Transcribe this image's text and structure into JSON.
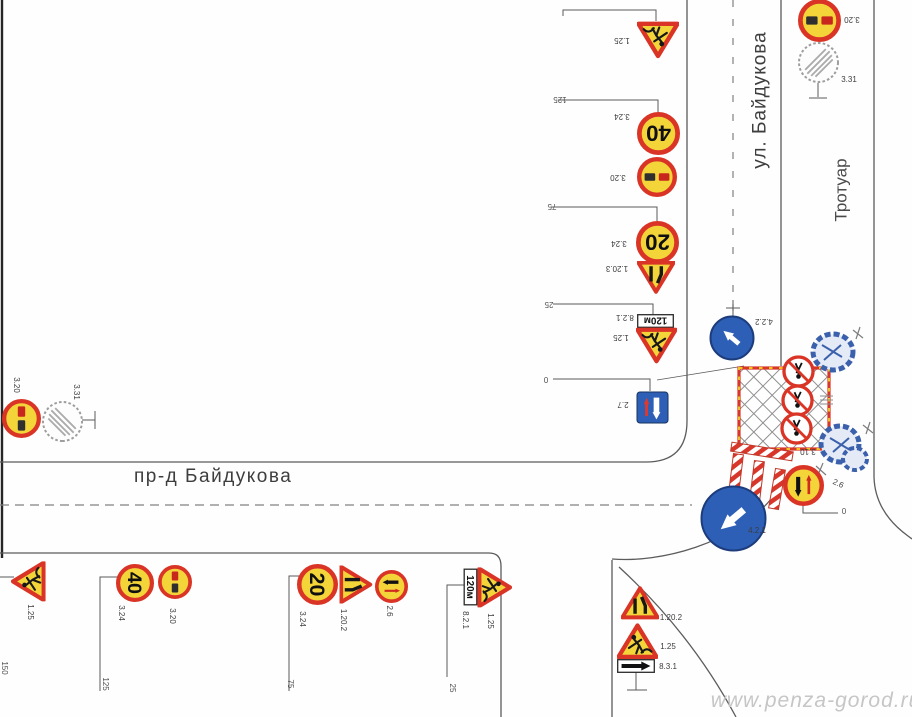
{
  "streets": {
    "vertical": "ул. Байдукова",
    "horizontal": "пр-д Байдукова",
    "sidewalk": "Тротуар"
  },
  "watermark": "www.penza-gorod.ru",
  "colors": {
    "sign_yellow": "#f3d53a",
    "sign_red": "#d93425",
    "sign_blue": "#2e5fb7",
    "zone_red": "#d8362a",
    "lamp_yellow": "#f2c21f",
    "tree_blue": "#3b60ac",
    "line_gray": "#5c5c5c"
  },
  "signs": [
    {
      "name": "sign-1.25-top",
      "t": "works",
      "x": 658,
      "y": 40,
      "s": 42,
      "rot": 180
    },
    {
      "name": "sign-3.24-40-top",
      "t": "speed",
      "tx": "40",
      "x": 658,
      "y": 133,
      "s": 43,
      "rot": 180
    },
    {
      "name": "sign-3.20-top",
      "t": "noov",
      "x": 657,
      "y": 177,
      "s": 40,
      "rot": 180
    },
    {
      "name": "sign-3.24-20-top",
      "t": "speed",
      "tx": "20",
      "x": 657,
      "y": 242,
      "s": 43,
      "rot": 180
    },
    {
      "name": "sign-1.20.3-top",
      "t": "narrowL",
      "x": 656,
      "y": 278,
      "s": 38,
      "rot": 180
    },
    {
      "name": "sign-8.2.1-top",
      "t": "plate",
      "tx": "120м",
      "x": 655,
      "y": 321,
      "w": 37,
      "h": 14,
      "rot": 180
    },
    {
      "name": "sign-1.25-mid",
      "t": "works",
      "x": 656,
      "y": 346,
      "s": 41,
      "rot": 180
    },
    {
      "name": "sign-2.7",
      "t": "prio",
      "x": 652,
      "y": 407,
      "s": 33,
      "rot": 180
    },
    {
      "name": "sign-3.20-ne",
      "t": "noov",
      "x": 819,
      "y": 20,
      "s": 43,
      "rot": 180
    },
    {
      "name": "sign-3.31-ne",
      "t": "endr",
      "x": 818,
      "y": 62,
      "s": 43,
      "rot": 0
    },
    {
      "name": "sign-3.20-w",
      "t": "noov",
      "x": 21,
      "y": 418,
      "s": 39,
      "rot": 90
    },
    {
      "name": "sign-3.31-w",
      "t": "endr",
      "x": 62,
      "y": 421,
      "s": 43,
      "rot": 90
    },
    {
      "name": "sign-4.2.2",
      "t": "barrow",
      "x": 732,
      "y": 338,
      "s": 46,
      "a": -50,
      "rot": 0
    },
    {
      "name": "sign-3.10-a",
      "t": "noped",
      "x": 798,
      "y": 371,
      "s": 33,
      "rot": 180
    },
    {
      "name": "sign-3.10-b",
      "t": "noped",
      "x": 797,
      "y": 400,
      "s": 33,
      "rot": 180
    },
    {
      "name": "sign-3.10-c",
      "t": "noped",
      "x": 796,
      "y": 428,
      "s": 33,
      "rot": 180
    },
    {
      "name": "sign-2.6-zone",
      "t": "onc",
      "x": 803,
      "y": 485,
      "s": 41,
      "rot": 0
    },
    {
      "name": "sign-4.2.1",
      "t": "barrow",
      "x": 733,
      "y": 518,
      "s": 67,
      "a": -130,
      "rot": 0
    },
    {
      "name": "sign-1.25-sw",
      "t": "works",
      "x": 28,
      "y": 581,
      "s": 40,
      "rot": -90
    },
    {
      "name": "sign-3.24-40-s",
      "t": "speed",
      "tx": "40",
      "x": 135,
      "y": 583,
      "s": 38,
      "rot": 90
    },
    {
      "name": "sign-3.20-s",
      "t": "noov",
      "x": 175,
      "y": 582,
      "s": 34,
      "rot": 90
    },
    {
      "name": "sign-3.24-20-s",
      "t": "speed",
      "tx": "20",
      "x": 317,
      "y": 584,
      "s": 41,
      "rot": 90
    },
    {
      "name": "sign-1.20.2-s",
      "t": "narrowR",
      "x": 356,
      "y": 585,
      "s": 38,
      "rot": 90
    },
    {
      "name": "sign-2.6-s",
      "t": "onc",
      "x": 391,
      "y": 586,
      "s": 33,
      "rot": 90
    },
    {
      "name": "sign-8.2.1-s",
      "t": "plate",
      "tx": "120м",
      "x": 470,
      "y": 587,
      "w": 37,
      "h": 14,
      "rot": 90
    },
    {
      "name": "sign-1.25-s2",
      "t": "works",
      "x": 495,
      "y": 587,
      "s": 40,
      "rot": 90
    },
    {
      "name": "sign-1.20.2-se",
      "t": "narrowR",
      "x": 640,
      "y": 603,
      "s": 38,
      "rot": 0
    },
    {
      "name": "sign-1.25-se",
      "t": "works",
      "x": 637,
      "y": 641,
      "s": 41,
      "rot": 0
    },
    {
      "name": "sign-8.3.1-se",
      "t": "parrow",
      "x": 636,
      "y": 666,
      "w": 38,
      "h": 14,
      "rot": 0
    }
  ],
  "labels": [
    {
      "text": "1.25",
      "x": 622,
      "y": 40,
      "rot": 180
    },
    {
      "text": "3.24",
      "x": 622,
      "y": 116,
      "rot": 180
    },
    {
      "text": "3.20",
      "x": 618,
      "y": 177,
      "rot": 180
    },
    {
      "text": "3.24",
      "x": 619,
      "y": 243,
      "rot": 180
    },
    {
      "text": "1.20.3",
      "x": 617,
      "y": 268,
      "rot": 180
    },
    {
      "text": "8.2.1",
      "x": 625,
      "y": 317,
      "rot": 180
    },
    {
      "text": "1.25",
      "x": 621,
      "y": 337,
      "rot": 180
    },
    {
      "text": "2.7",
      "x": 623,
      "y": 404,
      "rot": 180
    },
    {
      "text": "3.20",
      "x": 852,
      "y": 19,
      "rot": 180
    },
    {
      "text": "3.31",
      "x": 849,
      "y": 80,
      "rot": 0
    },
    {
      "text": "3.20",
      "x": 16,
      "y": 385,
      "rot": 90
    },
    {
      "text": "3.31",
      "x": 76,
      "y": 392,
      "rot": 90
    },
    {
      "text": "4.2.2",
      "x": 764,
      "y": 321,
      "rot": 180
    },
    {
      "text": "3.10",
      "x": 808,
      "y": 451,
      "rot": 180
    },
    {
      "text": "2.6",
      "x": 838,
      "y": 484,
      "rot": 25
    },
    {
      "text": "4.2.1",
      "x": 757,
      "y": 531,
      "rot": 0
    },
    {
      "text": "1.25",
      "x": 30,
      "y": 612,
      "rot": 90
    },
    {
      "text": "3.24",
      "x": 121,
      "y": 613,
      "rot": 90
    },
    {
      "text": "3.20",
      "x": 172,
      "y": 616,
      "rot": 90
    },
    {
      "text": "3.24",
      "x": 302,
      "y": 619,
      "rot": 90
    },
    {
      "text": "1.20.2",
      "x": 343,
      "y": 620,
      "rot": 90
    },
    {
      "text": "2.6",
      "x": 389,
      "y": 611,
      "rot": 90
    },
    {
      "text": "8.2.1",
      "x": 465,
      "y": 620,
      "rot": 90
    },
    {
      "text": "1.25",
      "x": 490,
      "y": 621,
      "rot": 90
    },
    {
      "text": "1.20.2",
      "x": 671,
      "y": 618,
      "rot": 0
    },
    {
      "text": "1.25",
      "x": 668,
      "y": 647,
      "rot": 0
    },
    {
      "text": "8.3.1",
      "x": 668,
      "y": 667,
      "rot": 0
    }
  ],
  "markers": [
    {
      "text": "125",
      "x": 560,
      "y": 99,
      "rot": 180
    },
    {
      "text": "75",
      "x": 552,
      "y": 206,
      "rot": 180
    },
    {
      "text": "25",
      "x": 549,
      "y": 304,
      "rot": 180
    },
    {
      "text": "0",
      "x": 546,
      "y": 379,
      "rot": 180
    },
    {
      "text": "0",
      "x": 844,
      "y": 512,
      "rot": 0
    },
    {
      "text": "150",
      "x": 4,
      "y": 668,
      "rot": 90
    },
    {
      "text": "125",
      "x": 105,
      "y": 684,
      "rot": 90
    },
    {
      "text": "75",
      "x": 290,
      "y": 684,
      "rot": 90
    },
    {
      "text": "25",
      "x": 452,
      "y": 688,
      "rot": 90
    }
  ]
}
